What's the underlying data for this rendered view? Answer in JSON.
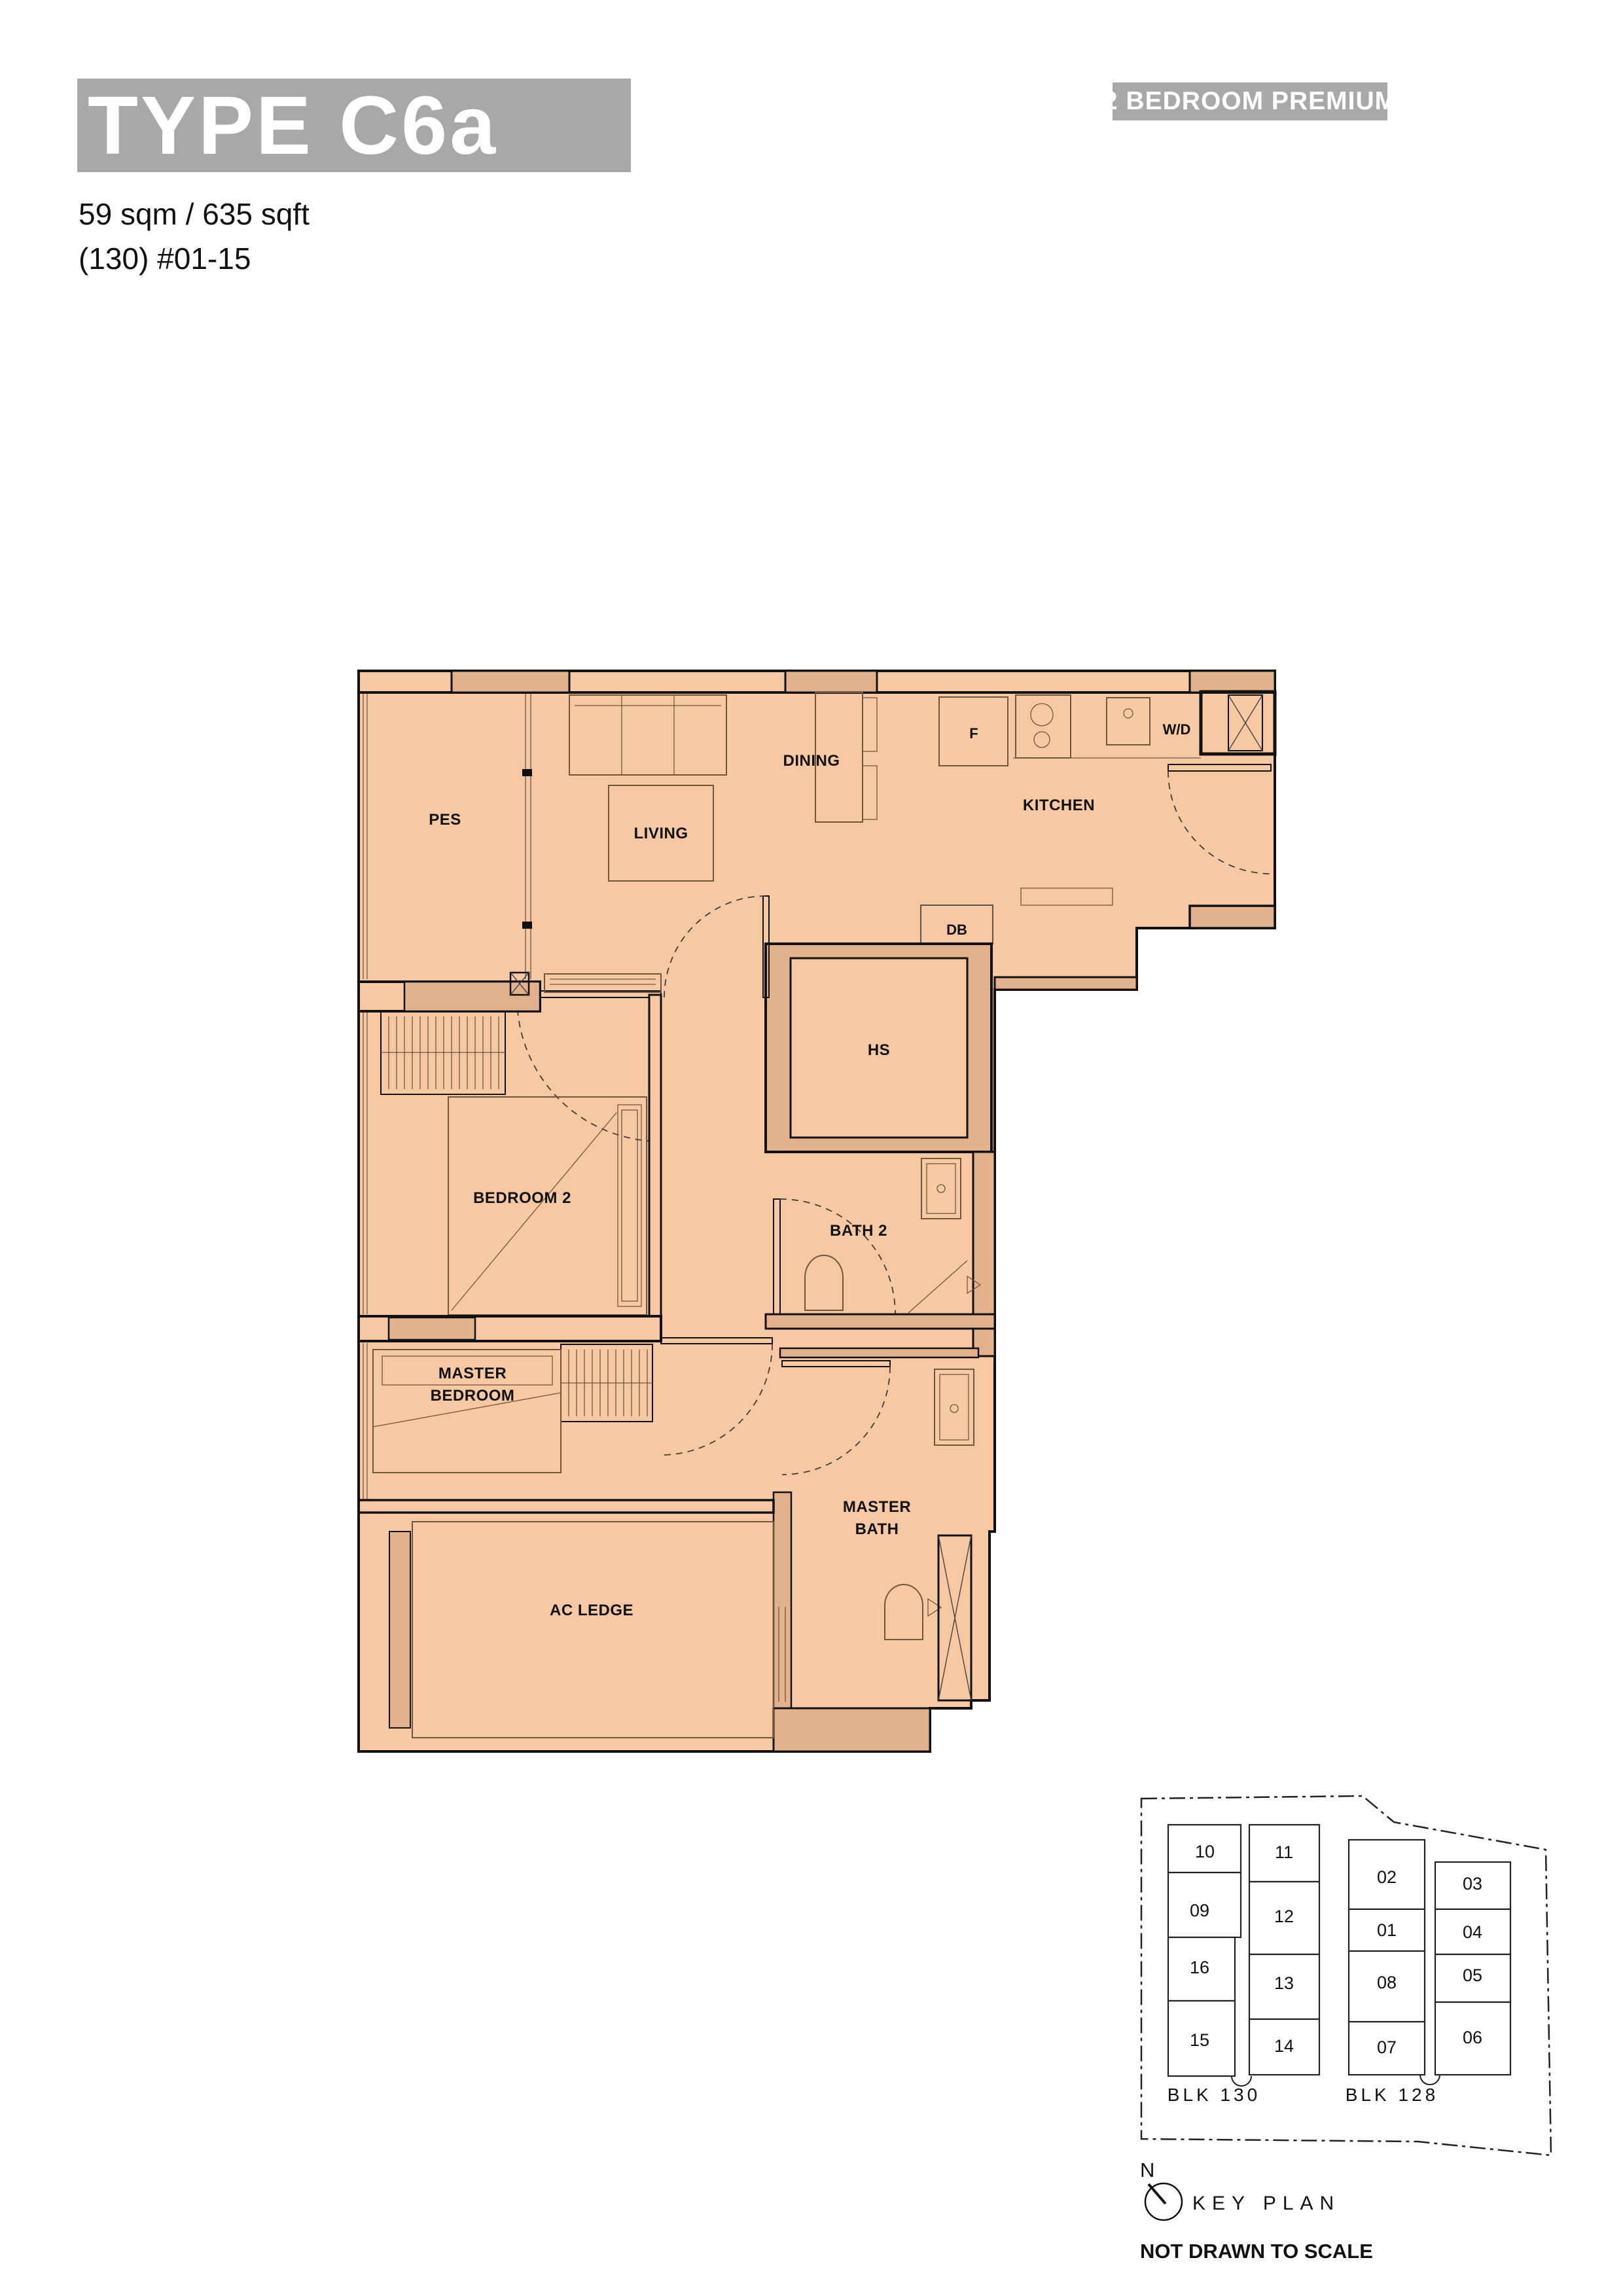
{
  "header": {
    "type_label": "TYPE C6a",
    "badge": "2 BEDROOM PREMIUM",
    "area_line": "59 sqm / 635 sqft",
    "unit_line": "(130) #01-15"
  },
  "plan": {
    "labels": {
      "pes": "PES",
      "living": "LIVING",
      "dining": "DINING",
      "kitchen": "KITCHEN",
      "fridge": "F",
      "washer_dryer": "W/D",
      "db": "DB",
      "hs": "HS",
      "bedroom2": "BEDROOM 2",
      "bath2": "BATH 2",
      "master_bedroom": [
        "MASTER",
        "BEDROOM"
      ],
      "master_bath": [
        "MASTER",
        "BATH"
      ],
      "ac_ledge": "AC LEDGE"
    },
    "colors": {
      "floor": "#f6c9a3",
      "wall": "#e1b28b",
      "outline": "#111111"
    }
  },
  "keyplan": {
    "cols": [
      [
        "10",
        "09",
        "16",
        "15"
      ],
      [
        "11",
        "12",
        "13",
        "14"
      ],
      [
        "02",
        "01",
        "08",
        "07"
      ],
      [
        "03",
        "04",
        "05",
        "06"
      ]
    ],
    "highlighted_unit": "15",
    "highlight_color": "#a9a9a9",
    "blocks": [
      "BLK 130",
      "BLK 128"
    ],
    "north_label": "N",
    "title": "KEY PLAN",
    "note": "NOT DRAWN TO SCALE"
  },
  "colors": {
    "accent_gray": "#a8a8a8"
  }
}
